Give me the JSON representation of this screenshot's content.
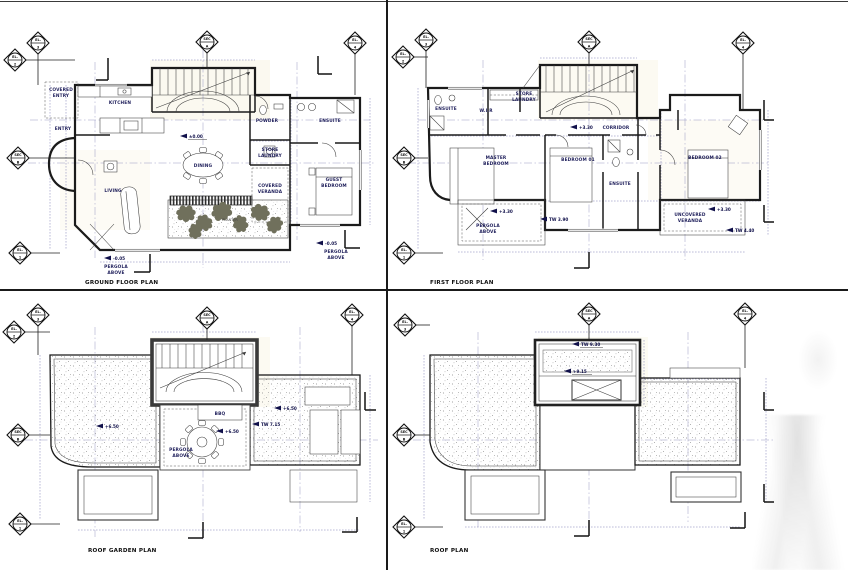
{
  "sheet": {
    "background": "#ffffff",
    "line_color": "#1b1b1b",
    "annotation_color": "#10104a",
    "dimension_color": "#6a6aa8"
  },
  "markers": {
    "sec_a": {
      "top": "SEC",
      "bottom": "A"
    },
    "sec_b": {
      "top": "SEC",
      "bottom": "B"
    },
    "el1": {
      "top": "EL.",
      "bottom": "1"
    },
    "el2": {
      "top": "EL.",
      "bottom": "2"
    },
    "el3": {
      "top": "EL.",
      "bottom": "3"
    },
    "el4": {
      "top": "EL.",
      "bottom": "4"
    }
  },
  "ground_floor": {
    "title": "GROUND FLOOR PLAN",
    "rooms": {
      "covered_entry": [
        "COVERED",
        "ENTRY"
      ],
      "kitchen": "KITCHEN",
      "entry": "ENTRY",
      "living": "LIVING",
      "dining": "DINING",
      "powder": "POWDER",
      "store_laundry": [
        "STORE",
        "LAUNDRY"
      ],
      "ensuite": "ENSUITE",
      "guest_bedroom": [
        "GUEST",
        "BEDROOM"
      ],
      "covered_veranda": [
        "COVERED",
        "VERANDA"
      ],
      "planter": "PLANTER"
    },
    "levels": {
      "main": "±0.00",
      "left": "-0.05",
      "right": "-0.05"
    },
    "notes": {
      "pergola_left": [
        "PERGOLA",
        "ABOVE"
      ],
      "pergola_right": [
        "PERGOLA",
        "ABOVE"
      ]
    }
  },
  "first_floor": {
    "title": "FIRST FLOOR PLAN",
    "rooms": {
      "ensuite_1": "ENSUITE",
      "wir": "W.I.R",
      "store_laundry": [
        "STORE",
        "LAUNDRY"
      ],
      "corridor": "CORRIDOR",
      "master_bedroom": [
        "MASTER",
        "BEDROOM"
      ],
      "bedroom_01": "BEDROOM 01",
      "ensuite_2": "ENSUITE",
      "bedroom_02": "BEDROOM 02"
    },
    "areas": {
      "pergola_above": [
        "PERGOLA",
        "ABOVE"
      ],
      "uncovered_veranda": [
        "UNCOVERED",
        "VERANDA"
      ]
    },
    "levels": {
      "corridor": "+3.30",
      "pergola": "+3.30",
      "veranda": "+3.30",
      "tw_pergola": "TW 3.90",
      "tw_veranda": "TW 4.40"
    }
  },
  "roof_garden": {
    "title": "ROOF GARDEN PLAN",
    "labels": {
      "bbq": "BBQ",
      "pergola_above": [
        "PERGOLA",
        "ABOVE"
      ]
    },
    "levels": {
      "left": "+6.50",
      "right": "+6.50",
      "terrace": "+6.50",
      "tw": "TW 7.15"
    }
  },
  "roof": {
    "title": "ROOF PLAN",
    "levels": {
      "tw": "TW 9.30",
      "top": "+9.15"
    }
  }
}
